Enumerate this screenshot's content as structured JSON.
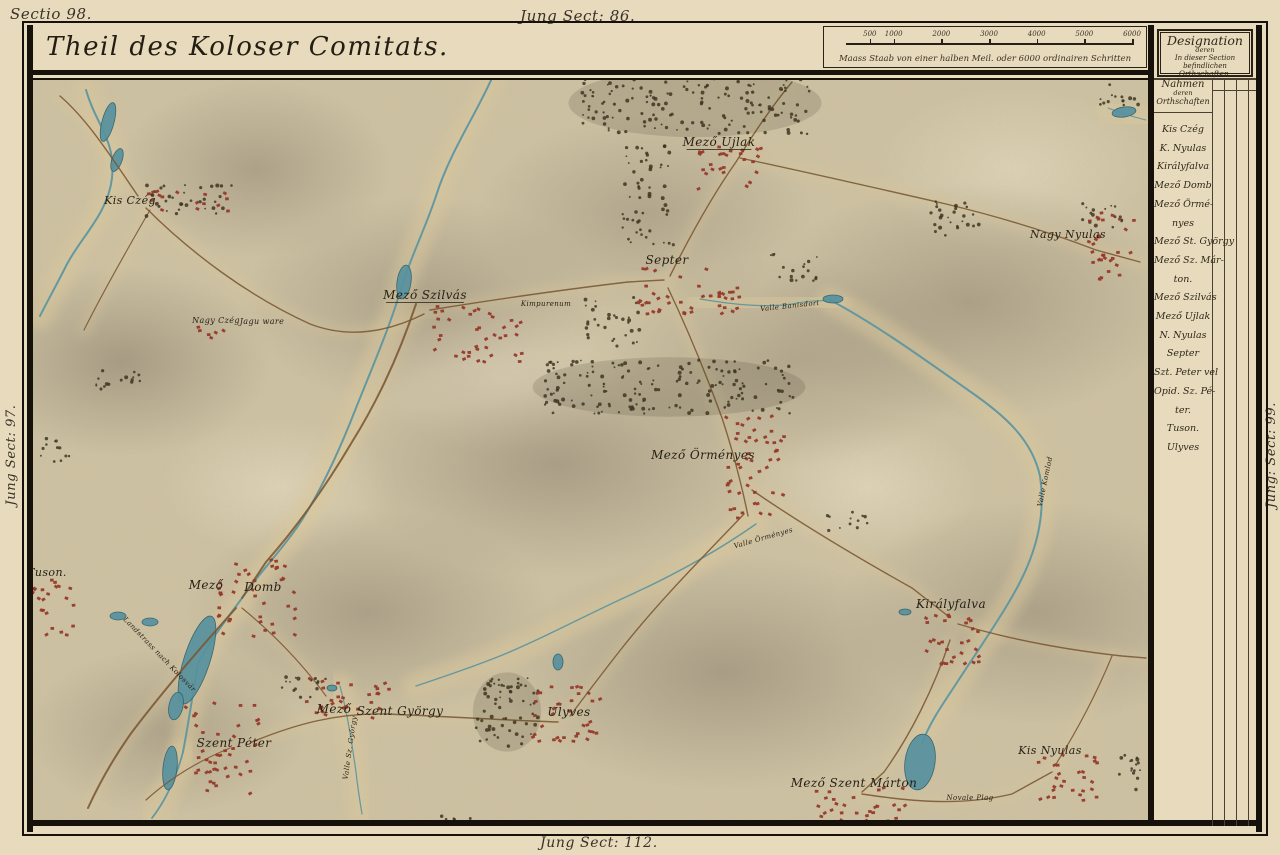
{
  "colors": {
    "parchment": "#e7dabd",
    "map_base": "#cdc1a2",
    "ink": "#2a2116",
    "frame": "#17110b",
    "water": "#5e96a0",
    "water_deep": "#57929f",
    "road": "#7a5632",
    "settlement_red": "#96392a",
    "forest_ink": "#39321f",
    "valley_tan": "#d9c79c"
  },
  "margins": {
    "top_left": "Sectio 98.",
    "top_center": "Jung Sect: 86.",
    "bottom_center": "Jung Sect: 112.",
    "left_rotated": "Jung Sect: 97.",
    "right_rotated": "Jung: Sect: 99."
  },
  "header": {
    "title": "Theil des Koloser Comitats.",
    "scale_caption": "Maass Staab von einer halben Meil. oder 6000 ordinairen Schritten",
    "scale_ticks": [
      "500",
      "1000",
      "2000",
      "3000",
      "4000",
      "5000",
      "6000"
    ]
  },
  "legend": {
    "designation_line1": "Designation",
    "designation_line2": "deren",
    "designation_line3": "In dieser Section befindlichen",
    "designation_line4": "Orthschaften.",
    "names_header_line1": "Nahmen",
    "names_header_line2": "deren",
    "names_header_line3": "Orthschaften",
    "entries": [
      "Kis Czég",
      "K. Nyulas",
      "Királyfalva",
      "Mező Domb",
      "Mező Örmé-",
      "nyes",
      "Mező St. György",
      "Mező Sz. Már-",
      "ton.",
      "Mező Szilvás",
      "Mező Ujlak",
      "N. Nyulas",
      "Septer",
      "Szt. Peter vel",
      "Opid. Sz. Pé-",
      "ter.",
      "Tuson.",
      "Ulyves"
    ]
  },
  "map": {
    "labels": [
      {
        "t": "Kis Czég",
        "x": 130,
        "y": 204,
        "s": 11
      },
      {
        "t": "Nagy Czég",
        "x": 216,
        "y": 323,
        "s": 8
      },
      {
        "t": "Jagu ware",
        "x": 262,
        "y": 324,
        "s": 8
      },
      {
        "t": "Mező Szilvás",
        "x": 425,
        "y": 299,
        "s": 12,
        "u": 1
      },
      {
        "t": "Kimpurenum",
        "x": 546,
        "y": 306,
        "s": 7
      },
      {
        "t": "Mező Ujlak",
        "x": 719,
        "y": 146,
        "s": 12,
        "u": 1
      },
      {
        "t": "Septer",
        "x": 667,
        "y": 264,
        "s": 12
      },
      {
        "t": "Nagy Nyulas",
        "x": 1068,
        "y": 238,
        "s": 11
      },
      {
        "t": "Mező Örményes",
        "x": 703,
        "y": 459,
        "s": 12
      },
      {
        "t": "Királyfalva",
        "x": 951,
        "y": 608,
        "s": 12
      },
      {
        "t": "Tuson.",
        "x": 47,
        "y": 576,
        "s": 11
      },
      {
        "t": "Mező",
        "x": 206,
        "y": 589,
        "s": 12
      },
      {
        "t": "Domb",
        "x": 263,
        "y": 591,
        "s": 12
      },
      {
        "t": "Szent Péter",
        "x": 234,
        "y": 747,
        "s": 12
      },
      {
        "t": "Mező",
        "x": 334,
        "y": 713,
        "s": 12
      },
      {
        "t": "Szent György",
        "x": 400,
        "y": 715,
        "s": 12
      },
      {
        "t": "Ulyves",
        "x": 569,
        "y": 716,
        "s": 12
      },
      {
        "t": "Mező Szent Márton",
        "x": 854,
        "y": 787,
        "s": 12
      },
      {
        "t": "Kis Nyulas",
        "x": 1050,
        "y": 754,
        "s": 11
      },
      {
        "t": "Valle Banisdori",
        "x": 790,
        "y": 308,
        "s": 7,
        "r": -6
      },
      {
        "t": "Valle Örményes",
        "x": 764,
        "y": 540,
        "s": 7,
        "r": -16
      },
      {
        "t": "Valle Komlod",
        "x": 1047,
        "y": 482,
        "s": 7,
        "r": -78
      },
      {
        "t": "Landstrass nach Kolosvár",
        "x": 158,
        "y": 656,
        "s": 7,
        "r": 46
      },
      {
        "t": "Valle Sz. György",
        "x": 352,
        "y": 748,
        "s": 7,
        "r": -82
      },
      {
        "t": "Novale Plag",
        "x": 970,
        "y": 800,
        "s": 7
      }
    ],
    "rivers": [
      {
        "d": "M 86,90 C 96,125 116,140 112,178 C 108,214 80,238 66,266 C 56,286 48,300 40,316",
        "w": 2
      },
      {
        "d": "M 492,78 C 474,118 450,152 436,196 C 424,232 410,258 400,292 C 390,326 372,368 356,408 C 342,444 322,490 298,526 C 280,552 262,570 248,590 C 226,620 210,640 198,664 C 190,710 188,726 183,752",
        "w": 2
      },
      {
        "d": "M 830,300 C 872,322 920,356 968,390 C 1006,416 1032,440 1040,476 C 1046,516 1036,552 1018,586 C 1002,616 978,650 956,684 C 940,708 928,726 922,744",
        "w": 2
      },
      {
        "d": "M 700,299 C 730,304 762,308 792,304 C 812,300 826,300 836,302",
        "w": 1.2
      },
      {
        "d": "M 756,524 C 716,552 672,576 628,596 C 584,616 540,640 500,656 C 470,668 440,678 416,686",
        "w": 1.4
      },
      {
        "d": "M 340,686 C 348,716 352,744 356,772 C 358,790 360,802 362,814",
        "w": 1.2
      },
      {
        "d": "M 183,752 C 176,778 166,800 152,818",
        "w": 1.8
      },
      {
        "d": "M 1146,120 C 1130,116 1118,112 1108,108",
        "w": 1
      }
    ],
    "lakes": [
      {
        "cx": 108,
        "cy": 122,
        "rx": 6,
        "ry": 20,
        "rot": 15
      },
      {
        "cx": 117,
        "cy": 160,
        "rx": 5,
        "ry": 12,
        "rot": 20
      },
      {
        "cx": 404,
        "cy": 282,
        "rx": 7,
        "ry": 17,
        "rot": 8
      },
      {
        "cx": 197,
        "cy": 660,
        "rx": 13,
        "ry": 46,
        "rot": 18
      },
      {
        "cx": 176,
        "cy": 706,
        "rx": 7,
        "ry": 14,
        "rot": 12
      },
      {
        "cx": 170,
        "cy": 768,
        "rx": 7,
        "ry": 22,
        "rot": 6
      },
      {
        "cx": 150,
        "cy": 622,
        "rx": 8,
        "ry": 4,
        "rot": 0
      },
      {
        "cx": 118,
        "cy": 616,
        "rx": 8,
        "ry": 4,
        "rot": 0
      },
      {
        "cx": 920,
        "cy": 762,
        "rx": 15,
        "ry": 28,
        "rot": 8
      },
      {
        "cx": 833,
        "cy": 299,
        "rx": 10,
        "ry": 4,
        "rot": 0
      },
      {
        "cx": 1124,
        "cy": 112,
        "rx": 12,
        "ry": 5,
        "rot": -8
      },
      {
        "cx": 905,
        "cy": 612,
        "rx": 6,
        "ry": 3,
        "rot": 0
      },
      {
        "cx": 558,
        "cy": 662,
        "rx": 5,
        "ry": 8,
        "rot": 0
      },
      {
        "cx": 332,
        "cy": 688,
        "rx": 5,
        "ry": 3,
        "rot": 0
      }
    ],
    "roads": [
      {
        "d": "M 60,96 C 88,120 112,158 138,196",
        "w": 1.4
      },
      {
        "d": "M 146,208 C 190,252 248,296 310,324 C 352,340 392,330 424,314",
        "w": 1.4
      },
      {
        "d": "M 430,310 C 492,300 560,290 628,282 L 664,280",
        "w": 1.4
      },
      {
        "d": "M 670,276 C 690,236 712,196 736,162 C 752,136 772,106 792,82",
        "w": 1.4
      },
      {
        "d": "M 740,158 C 806,172 876,188 946,204 C 996,216 1044,230 1096,250 L 1140,262",
        "w": 1.4
      },
      {
        "d": "M 668,288 C 688,330 706,374 722,418 C 732,448 742,486 748,516",
        "w": 1.4
      },
      {
        "d": "M 752,490 C 804,526 862,560 912,588 L 948,616",
        "w": 1.4
      },
      {
        "d": "M 958,624 C 1012,640 1068,650 1122,656 L 1146,658",
        "w": 1.4
      },
      {
        "d": "M 950,640 C 934,688 910,736 884,772 L 862,792",
        "w": 1.4
      },
      {
        "d": "M 744,514 C 704,556 660,600 622,648 C 600,676 582,700 570,716",
        "w": 1.4
      },
      {
        "d": "M 558,722 C 500,720 440,716 386,714 C 336,713 296,724 252,742",
        "w": 1.4
      },
      {
        "d": "M 416,304 C 402,346 382,394 352,442 C 326,486 296,528 266,562 L 242,598",
        "w": 2
      },
      {
        "d": "M 236,608 C 200,648 164,690 132,732 C 112,760 98,786 88,808",
        "w": 2
      },
      {
        "d": "M 242,608 C 276,636 304,666 326,696",
        "w": 1.2
      },
      {
        "d": "M 862,794 C 914,802 962,806 1012,794 L 1052,772",
        "w": 1.4
      },
      {
        "d": "M 1056,764 C 1080,726 1098,690 1112,656",
        "w": 1.2
      },
      {
        "d": "M 230,748 C 196,762 168,780 146,800",
        "w": 1.2
      },
      {
        "d": "M 150,210 C 128,248 104,290 84,330",
        "w": 1.2
      }
    ],
    "forests": [
      {
        "x": 580,
        "y": 72,
        "w": 230,
        "h": 62,
        "n": 170
      },
      {
        "x": 622,
        "y": 145,
        "w": 52,
        "h": 100,
        "n": 55
      },
      {
        "x": 760,
        "y": 250,
        "w": 60,
        "h": 32,
        "n": 18
      },
      {
        "x": 928,
        "y": 198,
        "w": 52,
        "h": 38,
        "n": 26
      },
      {
        "x": 1082,
        "y": 203,
        "w": 40,
        "h": 26,
        "n": 16
      },
      {
        "x": 140,
        "y": 183,
        "w": 92,
        "h": 34,
        "n": 34
      },
      {
        "x": 545,
        "y": 360,
        "w": 248,
        "h": 54,
        "n": 160
      },
      {
        "x": 585,
        "y": 295,
        "w": 55,
        "h": 52,
        "n": 32
      },
      {
        "x": 476,
        "y": 676,
        "w": 62,
        "h": 72,
        "n": 62
      },
      {
        "x": 282,
        "y": 676,
        "w": 46,
        "h": 24,
        "n": 16
      },
      {
        "x": 93,
        "y": 370,
        "w": 52,
        "h": 24,
        "n": 16
      },
      {
        "x": 826,
        "y": 510,
        "w": 46,
        "h": 22,
        "n": 12
      },
      {
        "x": 440,
        "y": 815,
        "w": 36,
        "h": 20,
        "n": 12
      },
      {
        "x": 1118,
        "y": 752,
        "w": 28,
        "h": 40,
        "n": 16
      },
      {
        "x": 1092,
        "y": 82,
        "w": 48,
        "h": 24,
        "n": 14
      },
      {
        "x": 40,
        "y": 436,
        "w": 30,
        "h": 28,
        "n": 12
      }
    ],
    "settlements": [
      {
        "x": 695,
        "y": 146,
        "w": 70,
        "h": 44,
        "n": 26
      },
      {
        "x": 636,
        "y": 268,
        "w": 104,
        "h": 46,
        "n": 42
      },
      {
        "x": 432,
        "y": 306,
        "w": 92,
        "h": 56,
        "n": 40
      },
      {
        "x": 726,
        "y": 416,
        "w": 62,
        "h": 106,
        "n": 48
      },
      {
        "x": 924,
        "y": 612,
        "w": 58,
        "h": 52,
        "n": 30
      },
      {
        "x": 214,
        "y": 558,
        "w": 82,
        "h": 86,
        "n": 40
      },
      {
        "x": 20,
        "y": 578,
        "w": 56,
        "h": 62,
        "n": 30
      },
      {
        "x": 184,
        "y": 698,
        "w": 76,
        "h": 96,
        "n": 42
      },
      {
        "x": 306,
        "y": 678,
        "w": 84,
        "h": 40,
        "n": 30
      },
      {
        "x": 532,
        "y": 686,
        "w": 76,
        "h": 56,
        "n": 36
      },
      {
        "x": 814,
        "y": 786,
        "w": 92,
        "h": 52,
        "n": 36
      },
      {
        "x": 1038,
        "y": 750,
        "w": 66,
        "h": 52,
        "n": 28
      },
      {
        "x": 1088,
        "y": 212,
        "w": 46,
        "h": 72,
        "n": 30
      },
      {
        "x": 148,
        "y": 190,
        "w": 84,
        "h": 26,
        "n": 16
      },
      {
        "x": 196,
        "y": 326,
        "w": 30,
        "h": 12,
        "n": 6
      }
    ]
  }
}
